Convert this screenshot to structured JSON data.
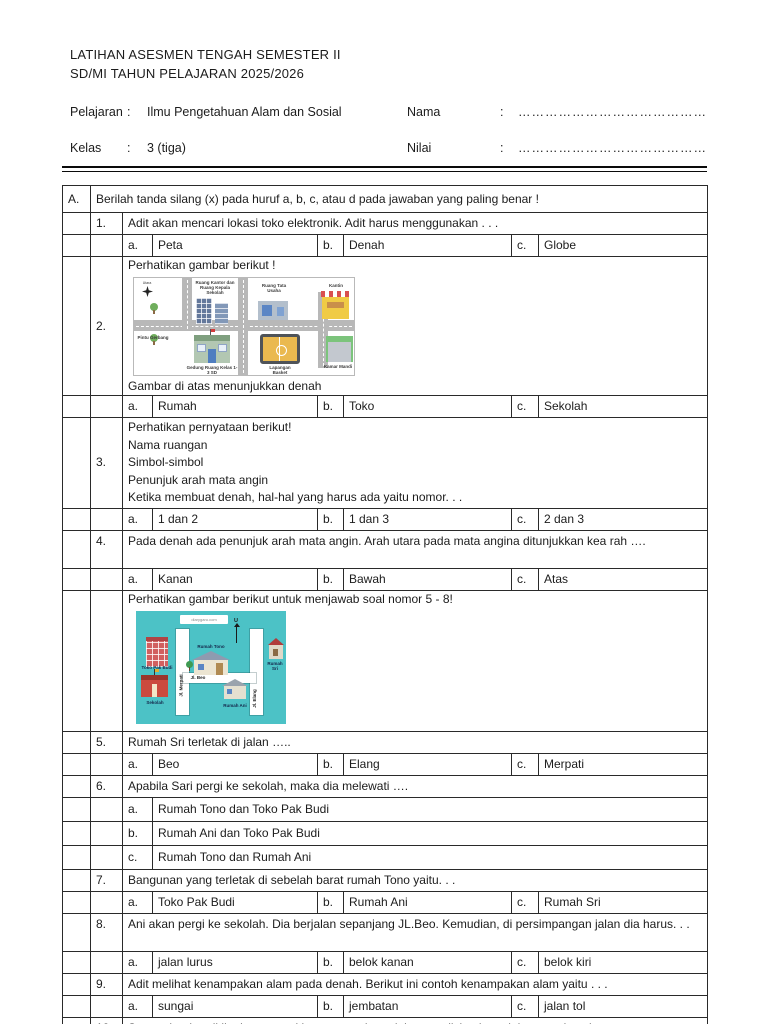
{
  "header": {
    "title1": "LATIHAN ASESMEN TENGAH SEMESTER II",
    "title2": "SD/MI TAHUN PELAJARAN 2025/2026",
    "colon": ":",
    "pelajaran_label": "Pelajaran",
    "pelajaran_value": "Ilmu Pengetahuan Alam dan Sosial",
    "kelas_label": "Kelas",
    "kelas_value": "3 (tiga)",
    "nama_label": "Nama",
    "nilai_label": "Nilai",
    "dotted_line": "……………………………………."
  },
  "section_a": {
    "letter": "A.",
    "instruction": "Berilah tanda silang (x) pada huruf a, b, c, atau d pada jawaban yang paling benar !"
  },
  "letters": {
    "a": "a.",
    "b": "b.",
    "c": "c."
  },
  "q1": {
    "num": "1.",
    "text": "Adit akan mencari lokasi toko elektronik. Adit harus menggunakan . . .",
    "opt_a": "Peta",
    "opt_b": "Denah",
    "opt_c": "Globe"
  },
  "q2": {
    "num": "2.",
    "intro": "Perhatikan gambar berikut !",
    "caption": "Gambar di atas menunjukkan denah",
    "opt_a": "Rumah",
    "opt_b": "Toko",
    "opt_c": "Sekolah"
  },
  "q3": {
    "num": "3.",
    "line1": "Perhatikan pernyataan berikut!",
    "line2": "Nama ruangan",
    "line3": "Simbol-simbol",
    "line4": "Penunjuk arah mata angin",
    "line5": "Ketika membuat denah, hal-hal yang harus ada yaitu nomor. . .",
    "opt_a": "1 dan 2",
    "opt_b": "1 dan 3",
    "opt_c": "2 dan 3"
  },
  "q4": {
    "num": "4.",
    "text": "Pada denah ada penunjuk arah mata angin. Arah utara pada mata angina ditunjukkan kea rah ….",
    "opt_a": "Kanan",
    "opt_b": "Bawah",
    "opt_c": "Atas"
  },
  "intro58": {
    "text": "Perhatikan gambar berikut  untuk menjawab soal nomor 5 - 8!"
  },
  "q5": {
    "num": "5.",
    "text": "Rumah Sri terletak di jalan …..",
    "opt_a": "Beo",
    "opt_b": "Elang",
    "opt_c": "Merpati"
  },
  "q6": {
    "num": "6.",
    "text": "Apabila Sari pergi ke sekolah, maka dia melewati ….",
    "opt_a": "Rumah Tono dan Toko Pak Budi",
    "opt_b": "Rumah Ani dan Toko Pak Budi",
    "opt_c": "Rumah Tono dan Rumah Ani"
  },
  "q7": {
    "num": "7.",
    "text": "Bangunan yang terletak di sebelah barat rumah Tono yaitu. . .",
    "opt_a": "Toko Pak Budi",
    "opt_b": "Rumah Ani",
    "opt_c": "Rumah Sri"
  },
  "q8": {
    "num": "8.",
    "text": "Ani akan pergi ke sekolah. Dia berjalan sepanjang JL.Beo. Kemudian, di persimpangan jalan dia harus. . .",
    "opt_a": "jalan lurus",
    "opt_b": "belok kanan",
    "opt_c": "belok kiri"
  },
  "q9": {
    "num": "9.",
    "text": "Adit melihat kenampakan alam pada denah. Berikut ini contoh kenampakan alam yaitu . . .",
    "opt_a": "sungai",
    "opt_b": "jembatan",
    "opt_c": "jalan tol"
  },
  "q10": {
    "num": "10.",
    "text": "Semua bagian di lingkungan sekitar yang terbentuk karena diciptakan oleh manusia yaitu. . .",
    "opt_a": "gejala alam",
    "opt_b": "kenampakan alam",
    "opt_c": "kenampakan buatan"
  },
  "school_map": {
    "compass_label": "Utara",
    "office_label": "Ruang Kantor dan Ruang Kepala Sekolah",
    "admin_label": "Ruang Tata Usaha",
    "canteen_label": "Kantin",
    "gate_label": "Pintu Gerbang",
    "classroom_label": "Gedung Ruang Kelas 1-3 SD",
    "court_label": "Lapangan Basket",
    "bathroom_label": "Kamar Mandi"
  },
  "street_map": {
    "watermark": "diarygaru.com",
    "north_label": "U",
    "shop_label": "Toko Pak Budi",
    "school_label": "Sekolah",
    "house_tono_label": "Rumah Tono",
    "house_ani_label": "Rumah Ani",
    "house_sri_label": "Rumah Sri",
    "road_merpati_label": "Jl. Merpati",
    "road_beo_label": "Jl. Beo",
    "road_elang_label": "Jl. Elang"
  },
  "colors": {
    "street_map_background": "#4cc2c6",
    "road_gray": "#b8b8b8",
    "court_orange": "#eab94f",
    "canteen_yellow": "#f0cb45",
    "school_red": "#cb4a3e"
  }
}
